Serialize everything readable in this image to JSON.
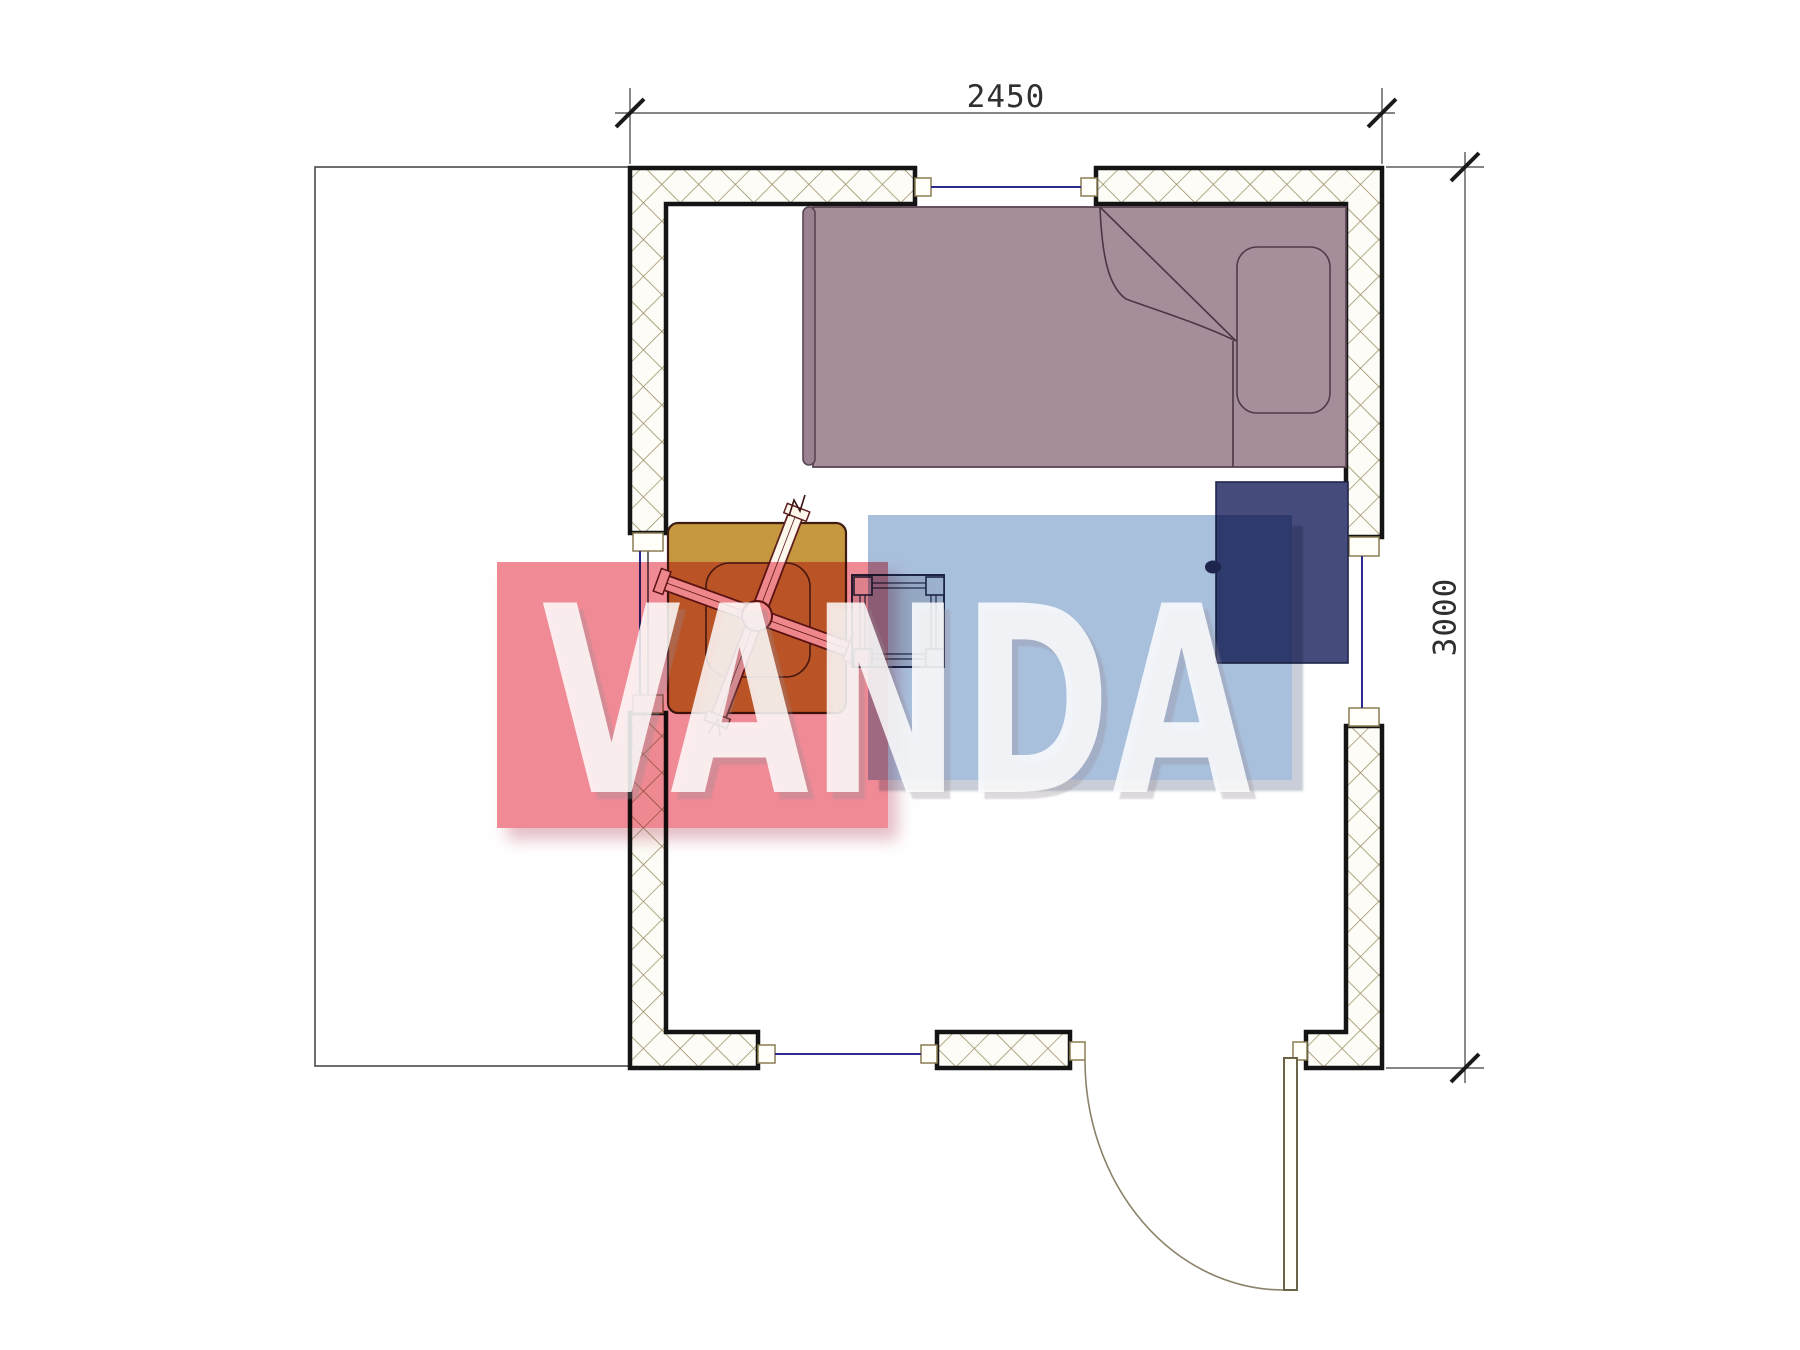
{
  "dimensions": {
    "top_label": "2450",
    "right_label": "3000"
  },
  "watermark": {
    "text": "VANDA",
    "red_block_color": "#f08b96",
    "blue_block_color": "#a9c0dd",
    "text_color": "rgba(255,255,255,0.84)"
  },
  "colors": {
    "bed": "#a68d9a",
    "bed_outline": "#5a4553",
    "footboard": "#9b8290",
    "pillow": "#a78f9c",
    "wardrobe": "#454c7c",
    "wardrobe_outline": "#20264a",
    "knob": "#2b3158",
    "table": "#c6983f",
    "table_outline": "#3f1d12",
    "fan_fill": "#fdf7ec",
    "fan_outline": "#5f2020",
    "stool": "#dcdce0",
    "stool_outline": "#2b3150",
    "wall_fill": "#fdfcf6",
    "wall_hatch": "#95895f",
    "wall_border": "#141414",
    "window_line": "#2b2b8e",
    "dimension_line": "#3c3c3c",
    "door_line": "#6b6347"
  },
  "elements": {
    "legend": [
      "terrace-outline",
      "hatched-walls",
      "window-top",
      "window-left",
      "window-right",
      "window-bottom",
      "entry-door",
      "door-swing-arc",
      "single-bed",
      "pillow",
      "blanket-fold",
      "wardrobe",
      "table",
      "ceiling-fan",
      "stool",
      "dimension-top",
      "dimension-right",
      "watermark"
    ]
  }
}
